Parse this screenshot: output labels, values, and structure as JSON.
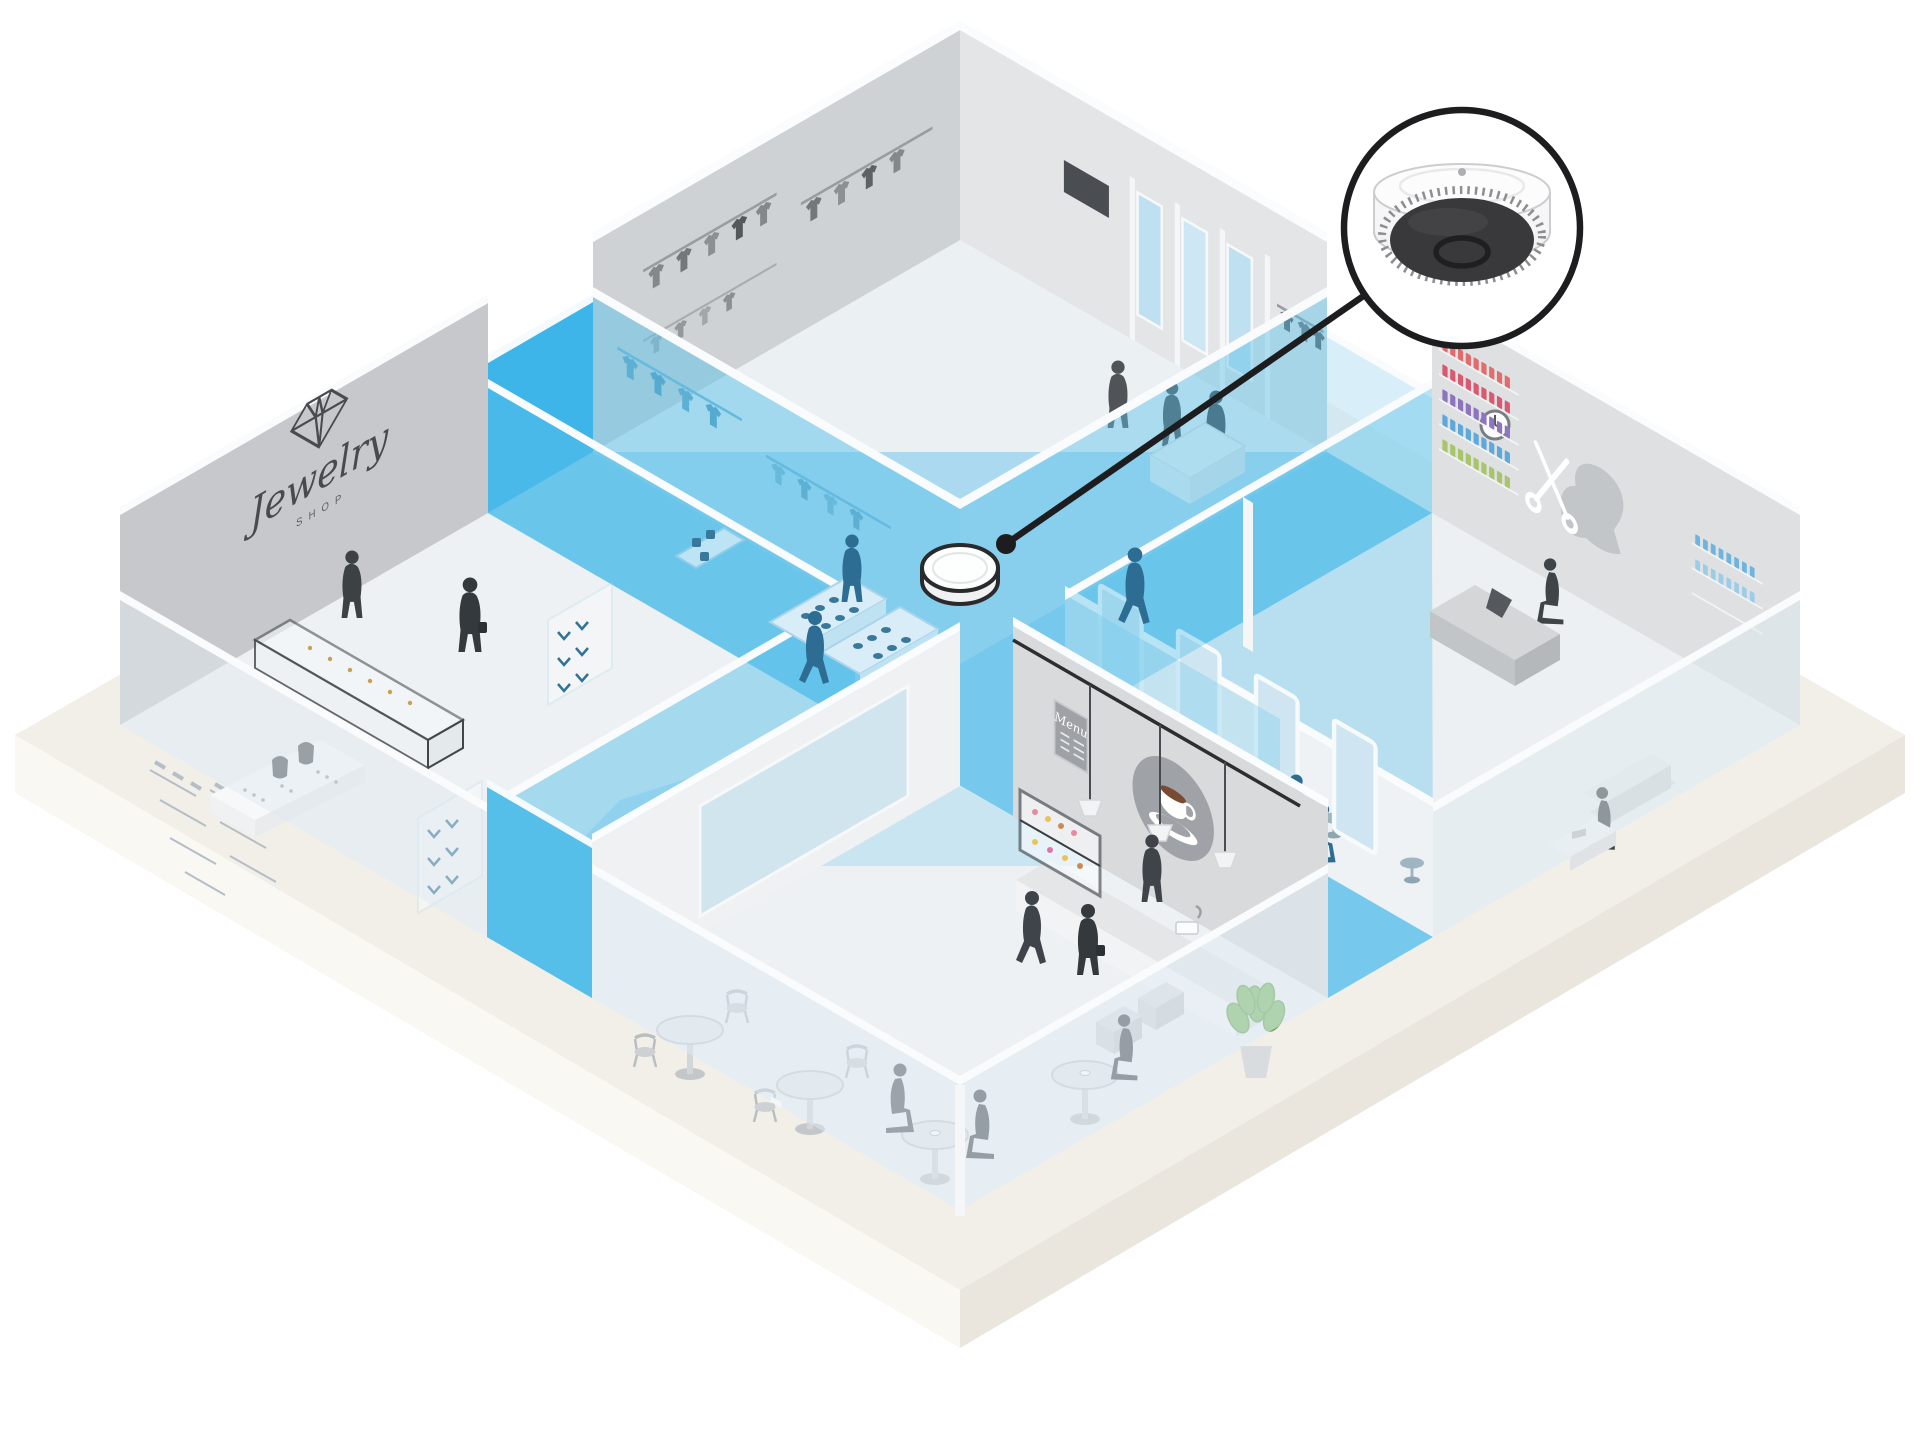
{
  "signs": {
    "jewelry_title": "Jewelry",
    "jewelry_subtitle": "SHOP",
    "cafe_menu_title": "Menu"
  },
  "icons": {
    "callout_camera": "fisheye-dome-camera-icon",
    "floor_camera": "ceiling-camera-disc-icon",
    "jewelry_logo": "diamond-icon",
    "cafe_logo": "coffee-cup-icon",
    "salon_art_scissors": "scissors-icon",
    "salon_art_profile": "woman-profile-icon",
    "salon_clock": "wall-clock-icon",
    "clothing_tv": "tv-screen-icon",
    "cafe_plant": "monstera-plant-icon"
  },
  "colors": {
    "background": "#FFFFFF",
    "coverage_blue": "#76C9EC",
    "coverage_bright_blue": "#3DB5E9",
    "glass_blue": "#5BC1E9",
    "platform_top": "#F2EFE9",
    "platform_side_left": "#FAF8F3",
    "platform_side_right": "#EAE5DD",
    "wall_gray": "#CFD2D4",
    "wall_light_gray": "#E3E5E7",
    "silhouette_dark": "#3E4246",
    "silhouette_blue": "#2E6D93",
    "callout_outline": "#1D1D1F"
  }
}
